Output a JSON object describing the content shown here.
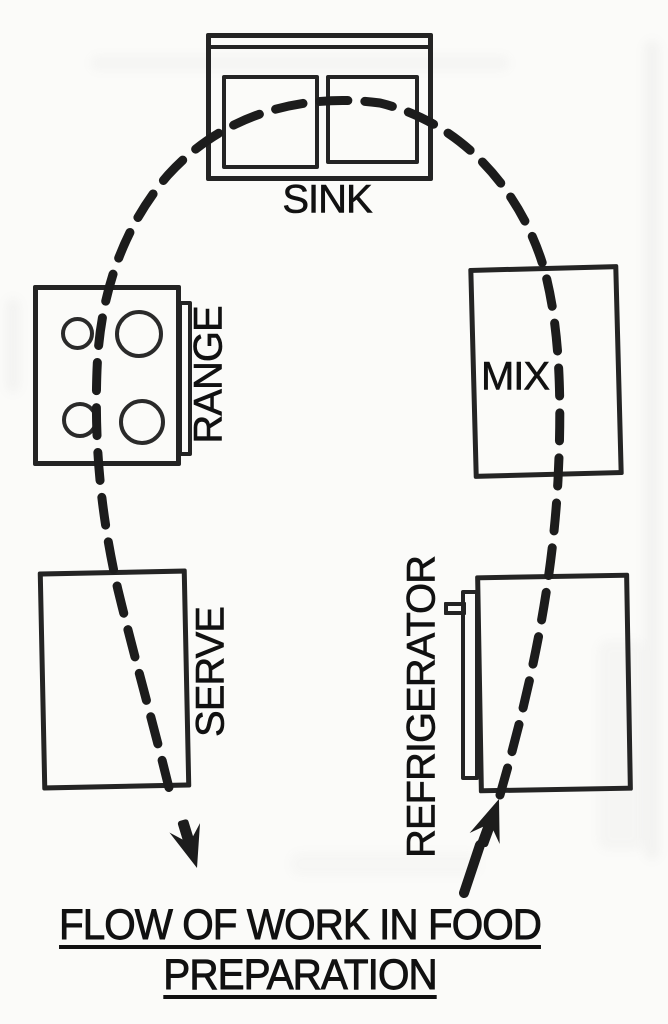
{
  "diagram": {
    "title_line1": "FLOW OF WORK IN FOOD",
    "title_line2": "PREPARATION",
    "stations": {
      "sink": {
        "label": "SINK"
      },
      "range": {
        "label": "RANGE"
      },
      "mix": {
        "label": "MIX"
      },
      "serve": {
        "label": "SERVE"
      },
      "refrigerator": {
        "label": "REFRIGERATOR"
      }
    },
    "flow": {
      "line_style": "thick dashed curve",
      "start_arrow": "points up into REFRIGERATOR",
      "end_arrow": "points down out of SERVE",
      "sequence": [
        "REFRIGERATOR",
        "MIX",
        "SINK",
        "RANGE",
        "SERVE"
      ]
    },
    "colors": {
      "line": "#1c1c1c",
      "text": "#111111",
      "background": "#fbfbf9"
    }
  }
}
